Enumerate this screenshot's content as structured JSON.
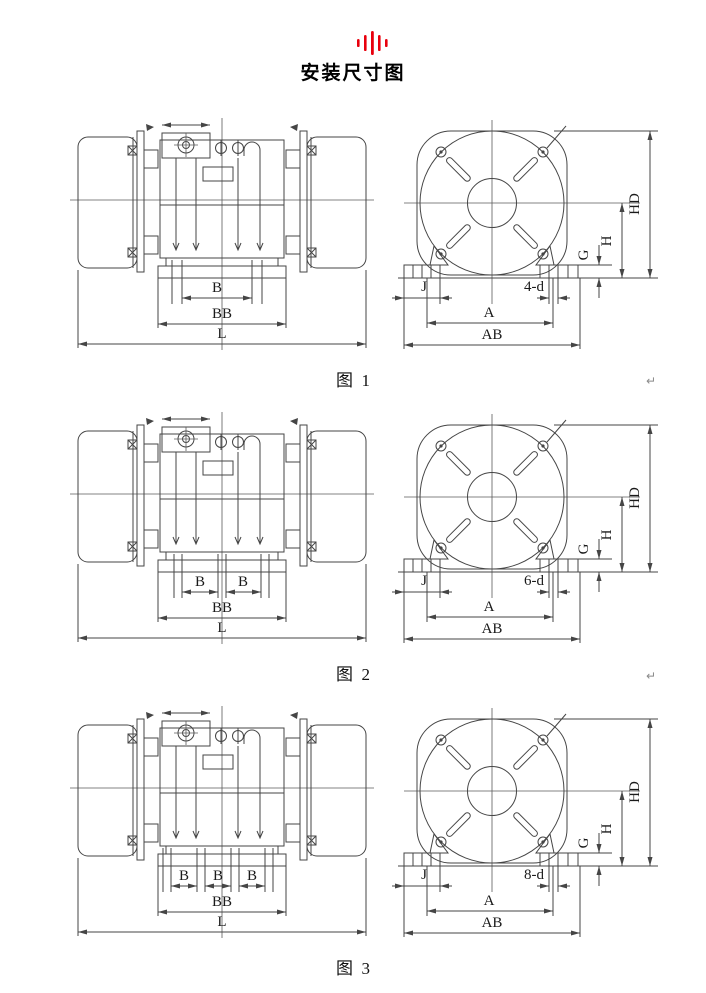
{
  "header": {
    "title": "安装尺寸图",
    "logo_color": "#e8000d"
  },
  "figures": [
    {
      "caption": "图  1",
      "side": {
        "b_labels": [
          "B"
        ],
        "bb": "BB",
        "l": "L"
      },
      "front": {
        "hd": "HD",
        "h": "H",
        "g": "G",
        "j": "J",
        "holes": "4-d",
        "a": "A",
        "ab": "AB"
      }
    },
    {
      "caption": "图  2",
      "side": {
        "b_labels": [
          "B",
          "B"
        ],
        "bb": "BB",
        "l": "L"
      },
      "front": {
        "hd": "HD",
        "h": "H",
        "g": "G",
        "j": "J",
        "holes": "6-d",
        "a": "A",
        "ab": "AB"
      }
    },
    {
      "caption": "图  3",
      "side": {
        "b_labels": [
          "B",
          "B",
          "B"
        ],
        "bb": "BB",
        "l": "L"
      },
      "front": {
        "hd": "HD",
        "h": "H",
        "g": "G",
        "j": "J",
        "holes": "8-d",
        "a": "A",
        "ab": "AB"
      }
    }
  ],
  "page_marks": {
    "return_glyph": "↵"
  }
}
